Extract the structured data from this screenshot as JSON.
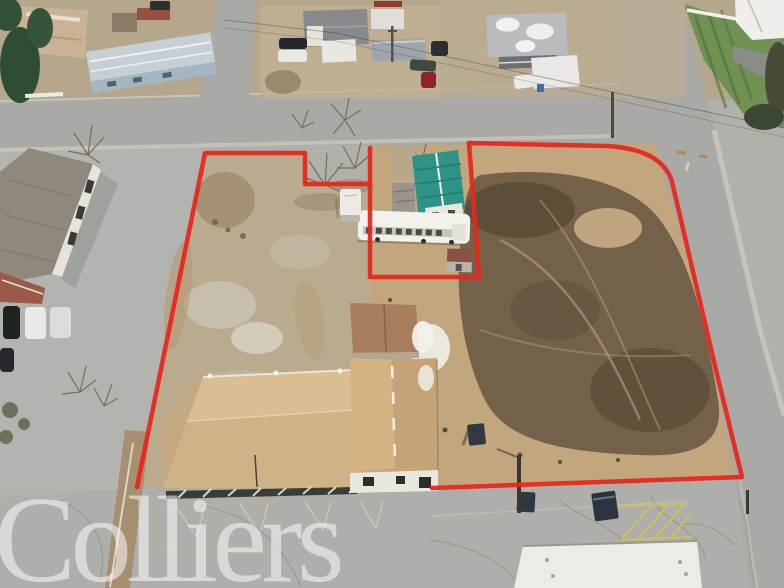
{
  "watermark": {
    "text": "Colliers"
  },
  "colors": {
    "boundary": "#e8271e",
    "dirt": "#c1a67e",
    "dark_soil": "#6b5a44",
    "pavement": "#b2b0aa",
    "road": "#a9a9a5",
    "teal_roof": "#2f9488",
    "building_roof_tan": "#d2b68a",
    "grass": "#6f9154"
  }
}
